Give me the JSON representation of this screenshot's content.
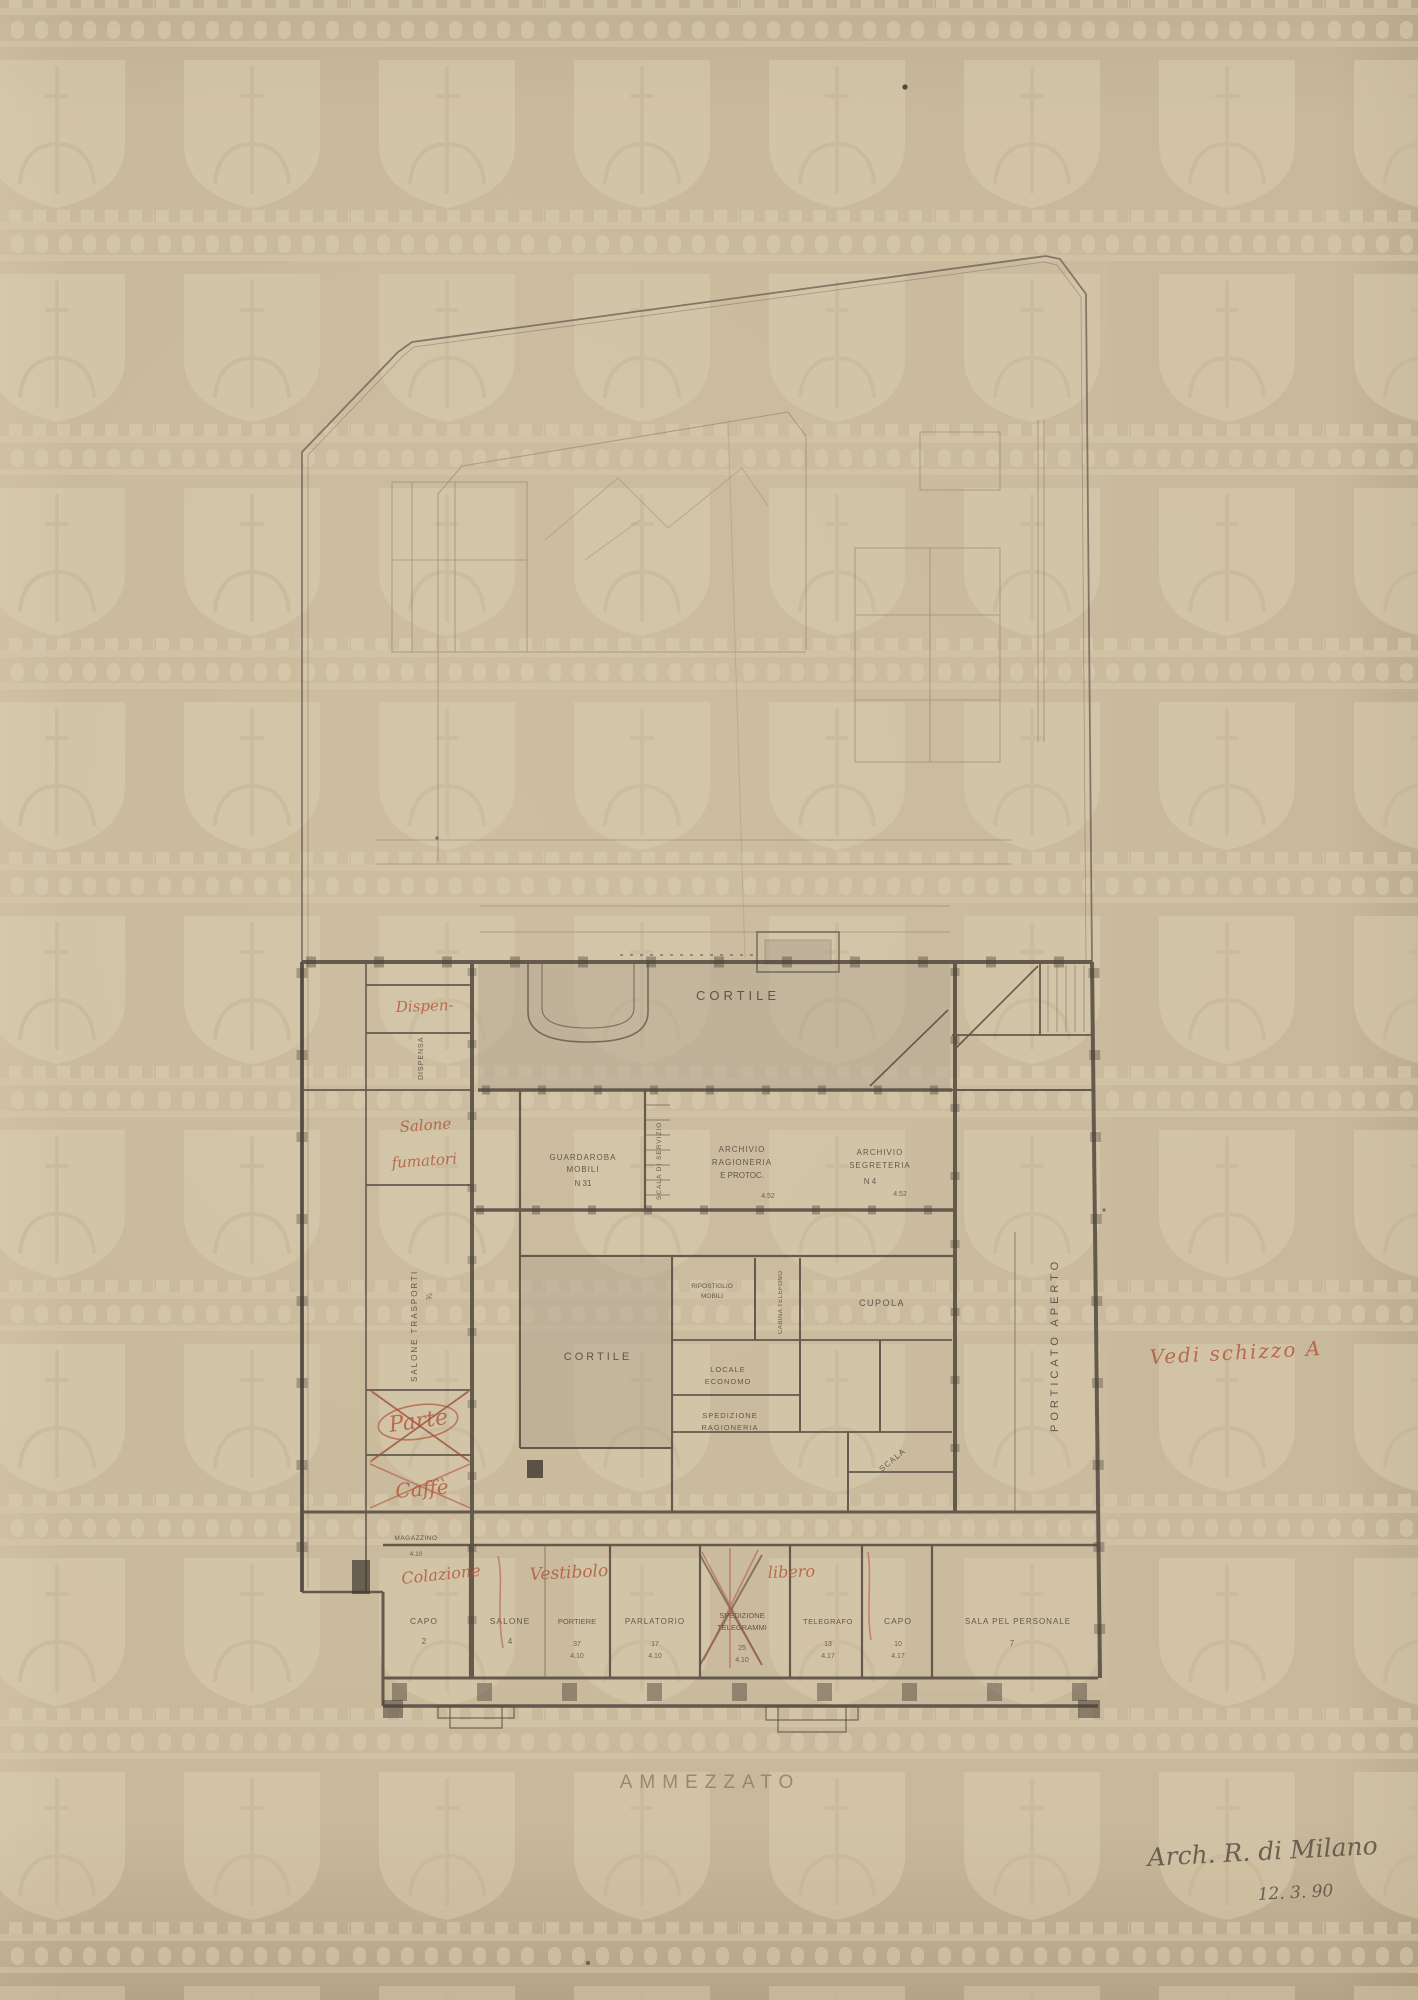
{
  "document": {
    "type": "archival architectural drawing, mezzanine floor plan",
    "title": "AMMEZZATO",
    "signature": {
      "line1": "Arch. R. di Milano",
      "line2": "12. 3. 90"
    }
  },
  "colors": {
    "paper": "#c9b99c",
    "pencil_dark": "#4a4238",
    "pencil_faint": "#8d7f6b",
    "red_ink": "#b0543a",
    "watermark": "#ddd0b2",
    "courtyard_shade": "#aea28e"
  },
  "watermark": {
    "motif": "crowned-battlement band with shield and drooping sword (fleur)",
    "tiling": "repeating grid"
  },
  "labels": {
    "cortile_main": "CORTILE",
    "cortile_small": "CORTILE",
    "dispensa_vert": "DISPENSA",
    "salone_trasporti_vert": "SALONE TRASPORTI",
    "magazzino": "MAGAZZINO",
    "guardaroba_l1": "GUARDAROBA",
    "guardaroba_l2": "MOBILI",
    "guardaroba_l3": "N 31",
    "scala_servizio_vert": "SCALA DI SERVIZIO",
    "archivio_rag_l1": "ARCHIVIO",
    "archivio_rag_l2": "RAGIONERIA",
    "archivio_rag_l3": "E PROTOC.",
    "archivio_seg_l1": "ARCHIVIO",
    "archivio_seg_l2": "SEGRETERIA",
    "archivio_seg_l3": "N 4",
    "ripost_l1": "RIPOSTIGLIO",
    "ripost_l2": "MOBILI",
    "cabina_telefono_vert": "CABINA TELEFONO",
    "cupola": "CUPOLA",
    "economo_l1": "LOCALE",
    "economo_l2": "ECONOMO",
    "spedizione_rag_l1": "SPEDIZIONE",
    "spedizione_rag_l2": "RAGIONERIA",
    "scala_diag": "SCALA",
    "porticato_vert": "PORTICATO APERTO",
    "room_capo_sx": "CAPO",
    "room_salone": "SALONE",
    "room_portiere": "PORTIERE",
    "room_parlatorio": "PARLATORIO",
    "room_sped_l1": "SPEDIZIONE",
    "room_sped_l2": "TELEGRAMMI",
    "room_telegrafo": "TELEGRAFO",
    "room_capo_dx": "CAPO",
    "room_sala": "SALA PEL PERSONALE"
  },
  "numbers": {
    "capo_sx_n": "2",
    "salone_n": "4",
    "portiere_n1": "37",
    "portiere_n2": "4.10",
    "parlatorio_n1": "17",
    "parlatorio_n2": "4.10",
    "sped_n1": "25",
    "sped_n2": "4.10",
    "telegrafo_n1": "13",
    "telegrafo_n2": "4.17",
    "capo_dx_n1": "10",
    "capo_dx_n2": "4.17",
    "sala_n": "7",
    "magazzino_n": "4.10",
    "trasporti_n": "¾",
    "rag_n": "4.52",
    "seg_n": "4.52"
  },
  "red_annotations": {
    "dispensa": "Dispen-",
    "salone_l1": "Salone",
    "salone_l2": "fumatori",
    "parte": "Parte",
    "caffe": "Caffè",
    "colazione": "Colazione",
    "vestibolo": "Vestibolo",
    "libero": "libero",
    "vedi_schizzo": "Vedi schizzo A"
  }
}
